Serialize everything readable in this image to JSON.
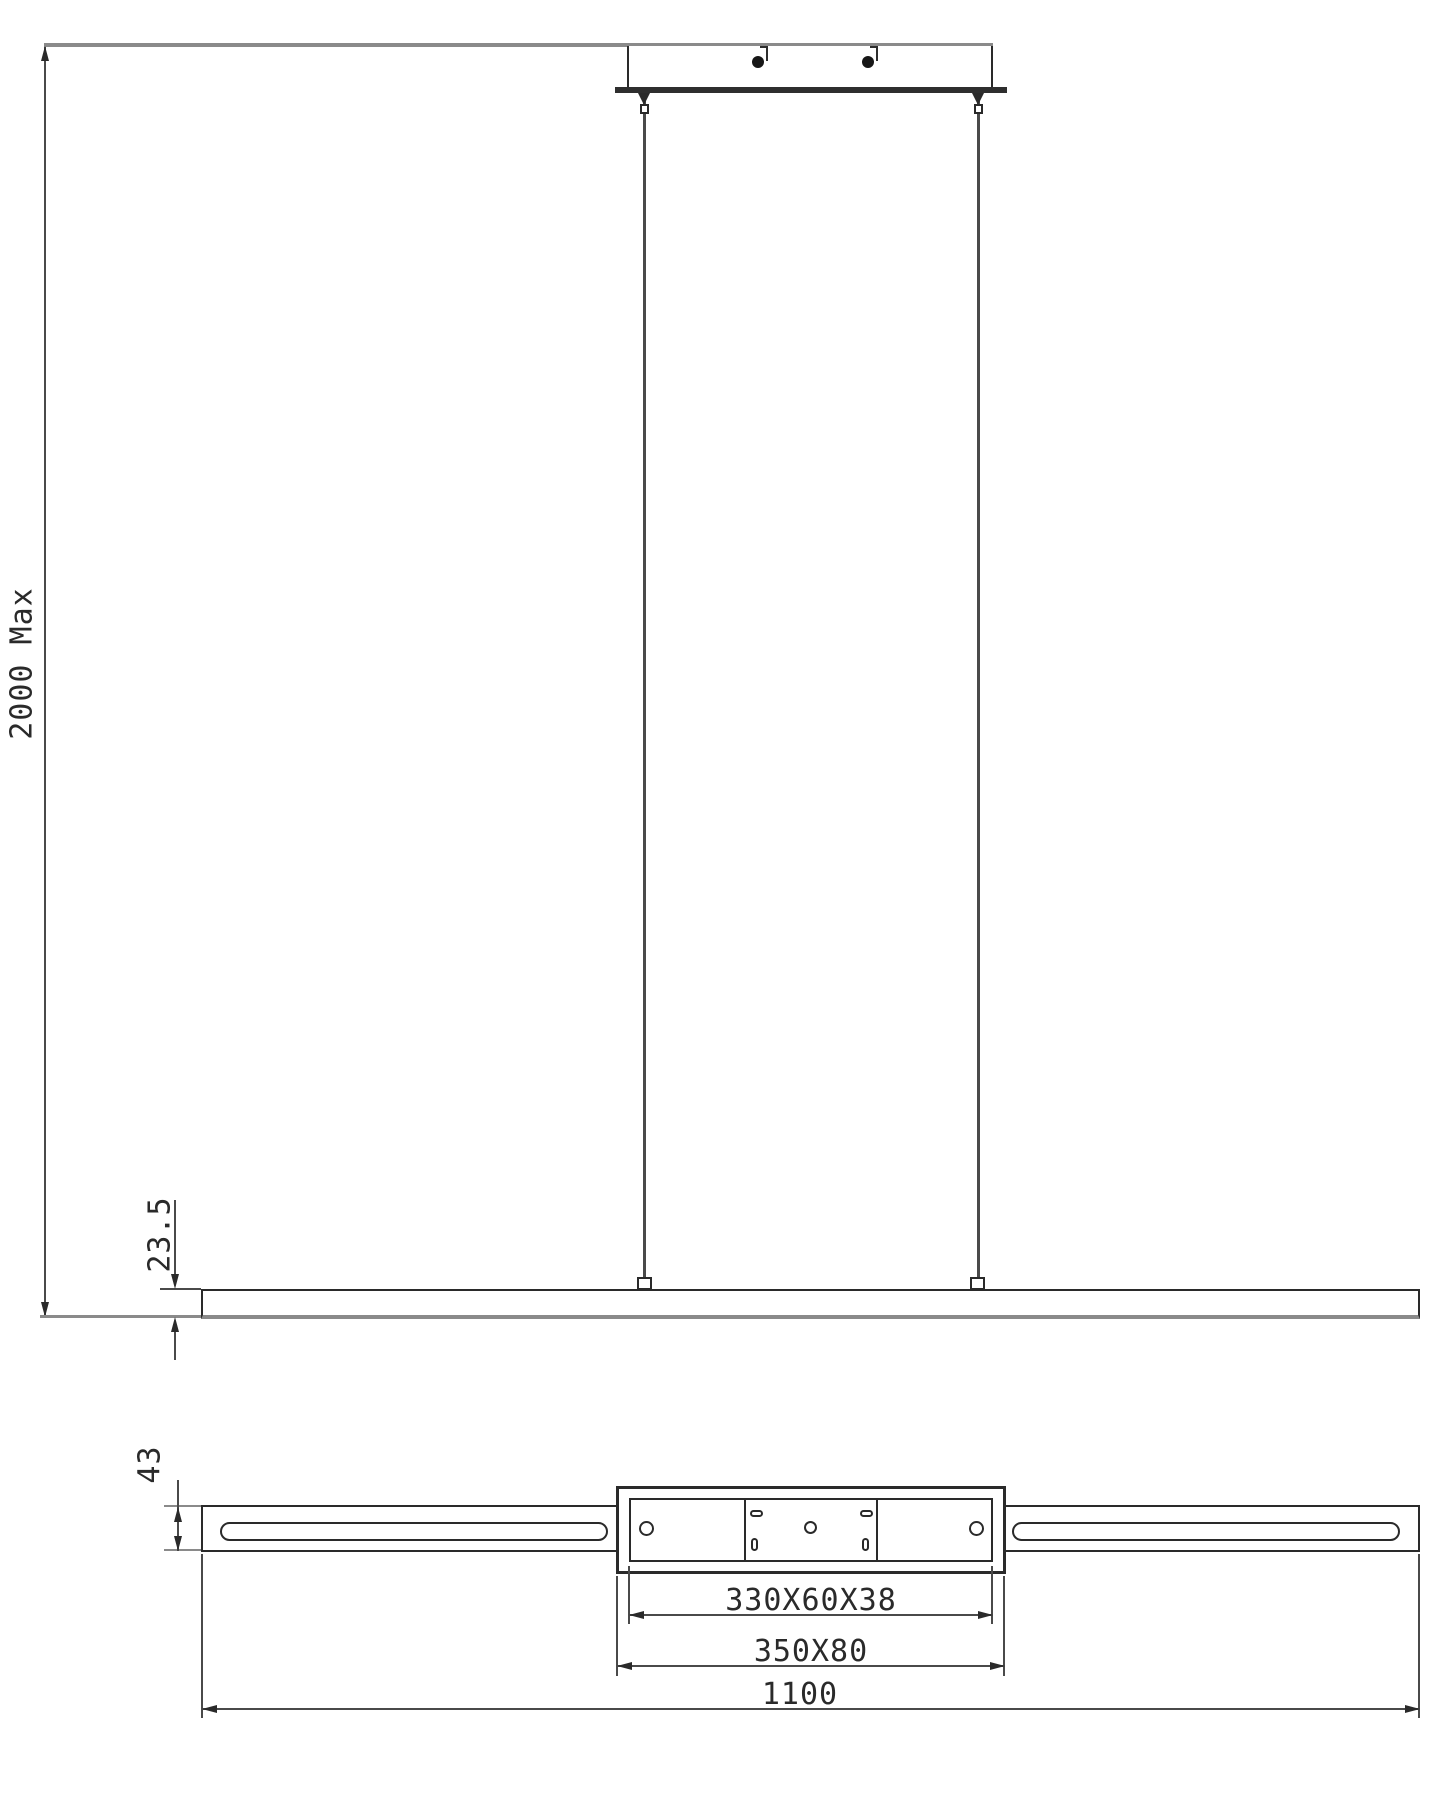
{
  "dimensions": {
    "max_drop": "2000 Max",
    "bar_thickness": "23.5",
    "bar_depth": "43",
    "driver_box_size": "330X60X38",
    "canopy_size": "350X80",
    "bar_length": "1100"
  }
}
